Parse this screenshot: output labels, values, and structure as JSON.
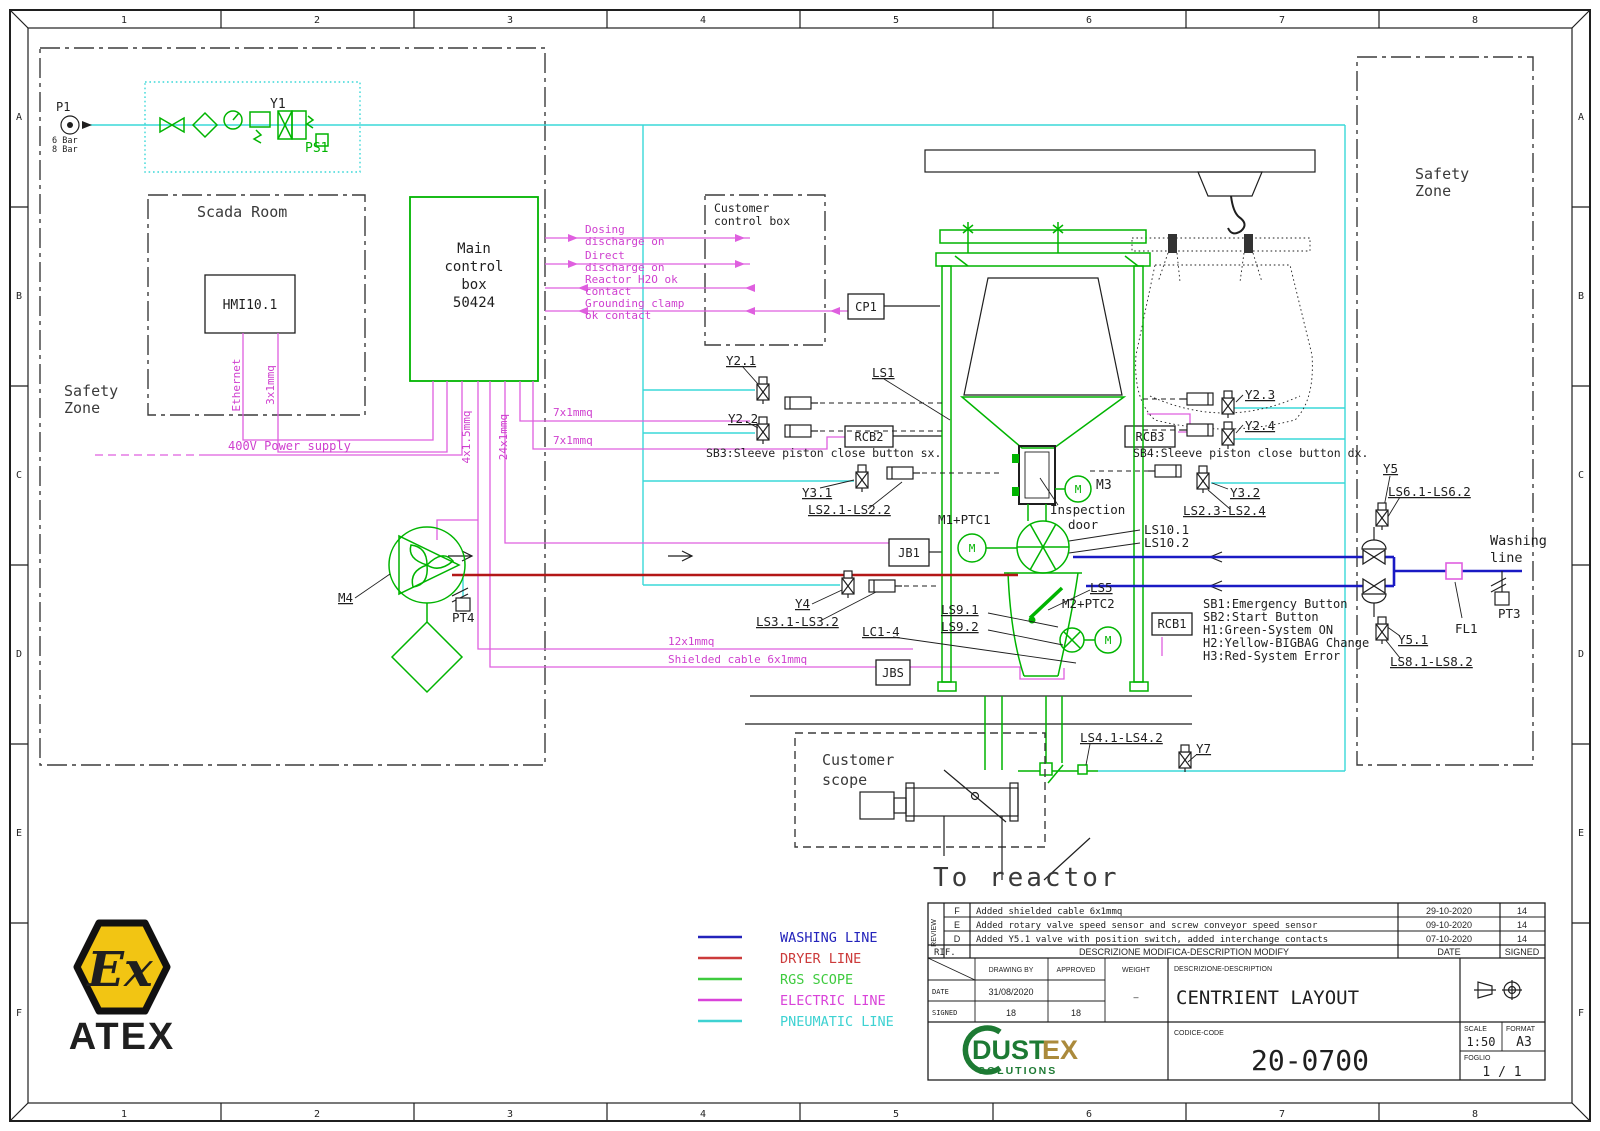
{
  "border": {
    "cols": [
      "1",
      "2",
      "3",
      "4",
      "5",
      "6",
      "7",
      "8"
    ],
    "rows": [
      "A",
      "B",
      "C",
      "D",
      "E",
      "F"
    ]
  },
  "zones": {
    "left_safety": {
      "l1": "Safety",
      "l2": "Zone"
    },
    "right_safety": {
      "l1": "Safety",
      "l2": "Zone"
    },
    "scada": "Scada Room",
    "customer_control": {
      "l1": "Customer",
      "l2": "control box"
    },
    "customer_scope": {
      "l1": "Customer",
      "l2": "scope"
    },
    "to_reactor": "To reactor"
  },
  "source": {
    "p1": "P1",
    "pressure_min": "6 Bar",
    "pressure_max": "8 Bar"
  },
  "skid": {
    "y1": "Y1",
    "ps1": "PS1"
  },
  "control": {
    "hmi": "HMI10.1",
    "main_l1": "Main",
    "main_l2": "control",
    "main_l3": "box",
    "main_l4": "50424",
    "cp1": "CP1"
  },
  "signals": {
    "items": [
      {
        "l1": "Dosing",
        "l2": "discharge on"
      },
      {
        "l1": "Direct",
        "l2": "discharge on"
      },
      {
        "l1": "Reactor H2O ok",
        "l2": "contact"
      },
      {
        "l1": "Grounding clamp",
        "l2": "ok contact"
      }
    ]
  },
  "wires": {
    "ethernet": "Ethernet",
    "hmi_cable": "3x1mmq",
    "power": "400V Power supply",
    "cable_4x15": "4x1.5mmq",
    "cable_24x1": "24x1mmq",
    "cable_7x1_a": "7x1mmq",
    "cable_7x1_b": "7x1mmq",
    "cable_12x1": "12x1mmq",
    "shielded": "Shielded cable 6x1mmq"
  },
  "devices": {
    "y21": "Y2.1",
    "y22": "Y2.2",
    "y23": "Y2.3",
    "y24": "Y2.4",
    "y31": "Y3.1",
    "y32": "Y3.2",
    "y4": "Y4",
    "y5": "Y5",
    "y51": "Y5.1",
    "y7": "Y7",
    "ls1": "LS1",
    "ls2_sx": "LS2.1-LS2.2",
    "ls2_dx": "LS2.3-LS2.4",
    "ls3": "LS3.1-LS3.2",
    "ls4": "LS4.1-LS4.2",
    "ls5": "LS5",
    "ls6": "LS6.1-LS6.2",
    "ls8": "LS8.1-LS8.2",
    "ls91": "LS9.1",
    "ls92": "LS9.2",
    "ls10_1": "LS10.1",
    "ls10_2": "LS10.2",
    "rcb1": "RCB1",
    "rcb2": "RCB2",
    "rcb3": "RCB3",
    "jb1": "JB1",
    "jbs": "JBS",
    "lc": "LC1-4",
    "m1": "M1+PTC1",
    "m2": "M2+PTC2",
    "m3": "M3",
    "m4": "M4",
    "pt3": "PT3",
    "pt4": "PT4",
    "fl1": "FL1",
    "inspection_l1": "Inspection",
    "inspection_l2": "door",
    "motor_glyph": "M"
  },
  "notes": {
    "sb3": "SB3:Sleeve piston close button sx.",
    "sb4": "SB4:Sleeve piston close button dx.",
    "panel": [
      "SB1:Emergency Button",
      "SB2:Start Button",
      "H1:Green-System ON",
      "H2:Yellow-BIGBAG Change",
      "H3:Red-System Error"
    ],
    "washing_l1": "Washing",
    "washing_l2": "line"
  },
  "legend": {
    "items": [
      {
        "label": "WASHING LINE",
        "color": "#2323bb"
      },
      {
        "label": "DRYER LINE",
        "color": "#cc3b3b"
      },
      {
        "label": "RGS SCOPE",
        "color": "#3ecb3e"
      },
      {
        "label": "ELECTRIC LINE",
        "color": "#d943d9"
      },
      {
        "label": "PNEUMATIC LINE",
        "color": "#3ed2d2"
      }
    ]
  },
  "titleblock": {
    "review_label": "REVIEW",
    "revisions": [
      {
        "rev": "F",
        "desc": "Added shielded cable 6x1mmq",
        "date": "29-10-2020",
        "signed": "14"
      },
      {
        "rev": "E",
        "desc": "Added rotary valve speed sensor and screw conveyor speed sensor",
        "date": "09-10-2020",
        "signed": "14"
      },
      {
        "rev": "D",
        "desc": "Added Y5.1 valve with position switch, added interchange contacts",
        "date": "07-10-2020",
        "signed": "14"
      }
    ],
    "rif_label": "RIF.",
    "modify_header": "DESCRIZIONE MODIFICA-DESCRIPTION MODIFY",
    "date_header": "DATE",
    "signed_header": "SIGNED",
    "drawing_by_header": "DRAWING BY",
    "approved_header": "APPROVED",
    "weight_header": "WEIGHT",
    "weight_value": "–",
    "date_label": "DATE",
    "date_value": "31/08/2020",
    "signed_label": "SIGNED",
    "signed_drawing": "18",
    "signed_approved": "18",
    "description_header": "DESCRIZIONE-DESCRIPTION",
    "description": "CENTRIENT LAYOUT",
    "code_header": "CODICE-CODE",
    "code": "20-0700",
    "scale_header": "SCALE",
    "scale_value": "1:50",
    "format_header": "FORMAT",
    "format_value": "A3",
    "sheet_header": "FOGLIO",
    "sheet_value": "1 / 1",
    "brand_main": "DUST",
    "brand_accent": "EX",
    "brand_sub": "SOLUTIONS"
  },
  "atex": {
    "ex_glyph": "Ex",
    "label": "ATEX"
  }
}
